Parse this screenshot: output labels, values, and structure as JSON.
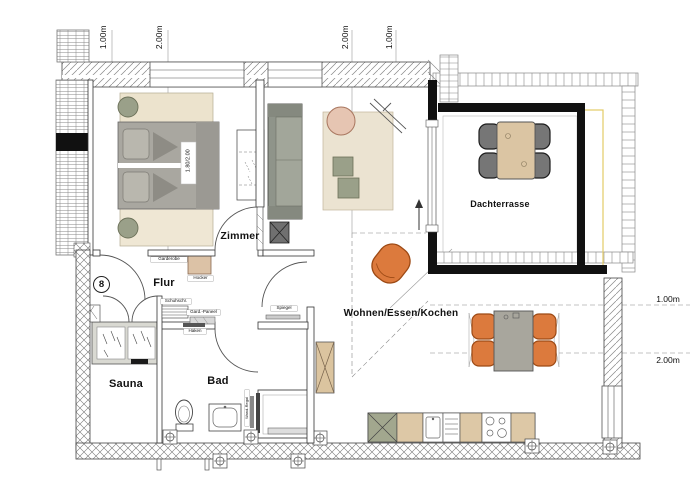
{
  "unit": {
    "number": "8"
  },
  "rooms": {
    "zimmer": "Zimmer",
    "flur": "Flur",
    "sauna": "Sauna",
    "bad": "Bad",
    "wohnen_essen_kochen": "Wohnen/Essen/Kochen",
    "dachterrasse": "Dachterrasse"
  },
  "dimensions": {
    "top": [
      "1.00m",
      "2.00m",
      "2.00m",
      "1.00m"
    ],
    "right": [
      "1.00m",
      "2.00m"
    ]
  },
  "furniture": {
    "bed_size": "1.80/2.00",
    "garderobe": "Garderobe",
    "hocker": "Hocker",
    "schuhschrank": "Schuhschr.",
    "gard_paneel": "Gard.-Paneel",
    "haken": "Haken",
    "spiegel": "Spiegel",
    "wand_regal": "Wand-Regal"
  },
  "colors": {
    "parapet_black": "#111111",
    "furniture_tan": "#ddc8a6",
    "furniture_olive": "#9aa089",
    "chair_orange": "#dc7a3d",
    "chair_orange_outline": "#9d4a15",
    "chair_pink": "#e6c5b2",
    "terrace_chair_gray": "#767676",
    "bed_gray": "#a9a7a0",
    "rug_beige": "#ebe3d1",
    "accent_yellow": "#e3cb66"
  }
}
